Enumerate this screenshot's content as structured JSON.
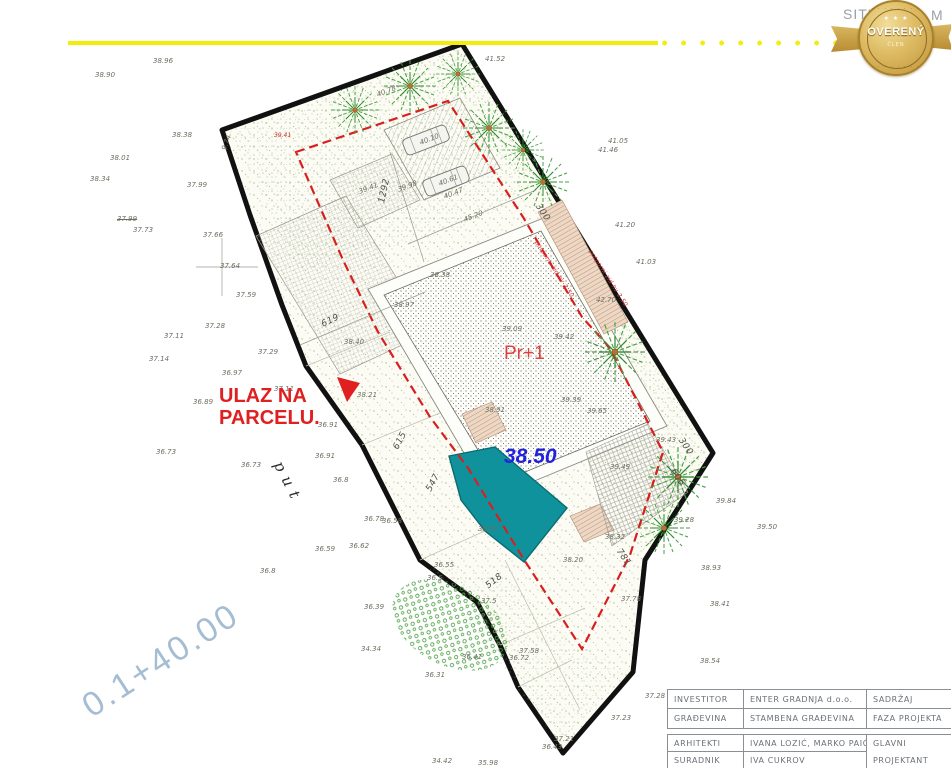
{
  "page": {
    "scale_note_left": "SITU",
    "scale_note_right": "M 1 :"
  },
  "badge": {
    "main": "OVERENÝ",
    "sub": "ČLEN",
    "stars": "★ ★ ★",
    "arc_top": "· · · · · · · ·",
    "arc_bottom": "· · · · · · · ·"
  },
  "plan": {
    "entrance_line1": "ULAZ NA",
    "entrance_line2": "PARCELU.",
    "building_label": "Pr+1",
    "pool_elevation": "38.50",
    "road_label": "put",
    "section_mark": "0.1+40.00",
    "labels": [
      {
        "t": "38.96",
        "x": 153,
        "y": 57
      },
      {
        "t": "38.90",
        "x": 95,
        "y": 71
      },
      {
        "t": "38.38",
        "x": 172,
        "y": 131
      },
      {
        "t": "38.01",
        "x": 110,
        "y": 154
      },
      {
        "t": "38.34",
        "x": 90,
        "y": 175
      },
      {
        "t": "37.99",
        "x": 187,
        "y": 181
      },
      {
        "t": "37.99",
        "x": 117,
        "y": 215,
        "cls": "strike"
      },
      {
        "t": "37.73",
        "x": 133,
        "y": 226
      },
      {
        "t": "37.66",
        "x": 203,
        "y": 231
      },
      {
        "t": "37.64",
        "x": 220,
        "y": 262
      },
      {
        "t": "37.59",
        "x": 236,
        "y": 291
      },
      {
        "t": "37.28",
        "x": 205,
        "y": 322
      },
      {
        "t": "37.11",
        "x": 164,
        "y": 332
      },
      {
        "t": "37.14",
        "x": 149,
        "y": 355
      },
      {
        "t": "37.29",
        "x": 258,
        "y": 348
      },
      {
        "t": "36.97",
        "x": 222,
        "y": 369
      },
      {
        "t": "37.11",
        "x": 274,
        "y": 385
      },
      {
        "t": "36.89",
        "x": 193,
        "y": 398
      },
      {
        "t": "38.21",
        "x": 357,
        "y": 391
      },
      {
        "t": "36.91",
        "x": 318,
        "y": 421
      },
      {
        "t": "36.91",
        "x": 315,
        "y": 452
      },
      {
        "t": "36.73",
        "x": 156,
        "y": 448
      },
      {
        "t": "36.73",
        "x": 241,
        "y": 461
      },
      {
        "t": "36.8",
        "x": 333,
        "y": 476
      },
      {
        "t": "36.78",
        "x": 364,
        "y": 515
      },
      {
        "t": "36.58",
        "x": 382,
        "y": 517
      },
      {
        "t": "36.62",
        "x": 349,
        "y": 542
      },
      {
        "t": "36.59",
        "x": 315,
        "y": 545
      },
      {
        "t": "36.8",
        "x": 260,
        "y": 567
      },
      {
        "t": "36.39",
        "x": 364,
        "y": 603
      },
      {
        "t": "34.34",
        "x": 361,
        "y": 645
      },
      {
        "t": "36.41",
        "x": 462,
        "y": 653
      },
      {
        "t": "36.31",
        "x": 425,
        "y": 671
      },
      {
        "t": "34.42",
        "x": 432,
        "y": 757
      },
      {
        "t": "35.98",
        "x": 478,
        "y": 759
      },
      {
        "t": "36.43",
        "x": 542,
        "y": 743
      },
      {
        "t": "37.21",
        "x": 554,
        "y": 735
      },
      {
        "t": "37.5",
        "x": 481,
        "y": 597
      },
      {
        "t": "37.58",
        "x": 519,
        "y": 647
      },
      {
        "t": "36.72",
        "x": 509,
        "y": 654
      },
      {
        "t": "37.78",
        "x": 621,
        "y": 595
      },
      {
        "t": "37.23",
        "x": 611,
        "y": 714
      },
      {
        "t": "37.28",
        "x": 645,
        "y": 692
      },
      {
        "t": "38.54",
        "x": 700,
        "y": 657
      },
      {
        "t": "38.41",
        "x": 710,
        "y": 600
      },
      {
        "t": "38.93",
        "x": 701,
        "y": 564
      },
      {
        "t": "39.50",
        "x": 757,
        "y": 523
      },
      {
        "t": "39.84",
        "x": 716,
        "y": 497
      },
      {
        "t": "39.28",
        "x": 674,
        "y": 516
      },
      {
        "t": "38.32",
        "x": 605,
        "y": 533
      },
      {
        "t": "39.49",
        "x": 610,
        "y": 463
      },
      {
        "t": "39.39",
        "x": 561,
        "y": 396
      },
      {
        "t": "39.65",
        "x": 587,
        "y": 407
      },
      {
        "t": "38.91",
        "x": 485,
        "y": 406
      },
      {
        "t": "39.42",
        "x": 554,
        "y": 333
      },
      {
        "t": "39.09",
        "x": 502,
        "y": 325
      },
      {
        "t": "38.38",
        "x": 430,
        "y": 271
      },
      {
        "t": "38.97",
        "x": 394,
        "y": 301
      },
      {
        "t": "38.40",
        "x": 344,
        "y": 338
      },
      {
        "t": "45.20",
        "x": 464,
        "y": 216,
        "r": -21
      },
      {
        "t": "40.47",
        "x": 444,
        "y": 193,
        "r": -21
      },
      {
        "t": "40.10",
        "x": 420,
        "y": 139,
        "r": -21
      },
      {
        "t": "40.61",
        "x": 439,
        "y": 180,
        "r": -21
      },
      {
        "t": "39.98",
        "x": 398,
        "y": 186,
        "r": -21
      },
      {
        "t": "39.41",
        "x": 359,
        "y": 188,
        "r": -21
      },
      {
        "t": "40.78",
        "x": 377,
        "y": 91,
        "r": -21
      },
      {
        "t": "41.52",
        "x": 485,
        "y": 55
      },
      {
        "t": "41.05",
        "x": 608,
        "y": 137
      },
      {
        "t": "41.46",
        "x": 598,
        "y": 146
      },
      {
        "t": "41.20",
        "x": 615,
        "y": 221
      },
      {
        "t": "41.03",
        "x": 636,
        "y": 258
      },
      {
        "t": "39.43",
        "x": 656,
        "y": 436
      },
      {
        "t": "42.70",
        "x": 596,
        "y": 296
      },
      {
        "t": "38.20",
        "x": 563,
        "y": 556
      },
      {
        "t": "38.01",
        "x": 478,
        "y": 525
      },
      {
        "t": "36.55",
        "x": 434,
        "y": 561
      },
      {
        "t": "36.5",
        "x": 427,
        "y": 574
      },
      {
        "t": "9.74",
        "x": 224,
        "y": 146,
        "r": -70
      },
      {
        "t": "39.41",
        "x": 274,
        "y": 132,
        "cls": "red"
      },
      {
        "t": "1292",
        "x": 382,
        "y": 198,
        "r": -78,
        "cls": "dim"
      },
      {
        "t": "619",
        "x": 322,
        "y": 320,
        "r": -25,
        "cls": "dim"
      },
      {
        "t": "615",
        "x": 396,
        "y": 444,
        "r": -62,
        "cls": "dim"
      },
      {
        "t": "547",
        "x": 429,
        "y": 486,
        "r": -62,
        "cls": "dim"
      },
      {
        "t": "518",
        "x": 487,
        "y": 582,
        "r": -38,
        "cls": "dim"
      },
      {
        "t": "781",
        "x": 618,
        "y": 545,
        "r": 55,
        "cls": "dim"
      },
      {
        "t": "300",
        "x": 537,
        "y": 200,
        "r": 55,
        "cls": "dim"
      },
      {
        "t": "300",
        "x": 680,
        "y": 434,
        "r": 55,
        "cls": "dim"
      },
      {
        "t": "606",
        "x": 672,
        "y": 465,
        "r": 55,
        "cls": "dim"
      },
      {
        "t": "potporni zid hv 2.50",
        "x": 536,
        "y": 238,
        "r": 57,
        "cls": "note"
      },
      {
        "t": "potporni zid hv 2.50",
        "x": 590,
        "y": 247,
        "r": 57,
        "cls": "note"
      }
    ]
  },
  "titleblock": {
    "rows": [
      {
        "label": "INVESTITOR",
        "value": "ENTER GRADNJA d.o.o.",
        "side": "SADRŽAJ"
      },
      {
        "label": "GRAĐEVINA",
        "value": "STAMBENA  GRAĐEVINA",
        "side": "FAZA  PROJEKTA"
      },
      {
        "label": "ARHITEKTI",
        "value": "IVANA  LOZIĆ,  MARKO  PAIĆ",
        "side": "GLAVNI"
      },
      {
        "label": "SURADNIK",
        "value": "IVA CUKROV",
        "side": "PROJEKTANT"
      }
    ]
  },
  "colors": {
    "accent_yellow": "#f2ee0b",
    "boundary_black": "#111111",
    "setback_red": "#d81f1f",
    "pool_teal": "#10929c",
    "entrance_red": "#e02020",
    "elevation_blue": "#2222dd",
    "section_blue": "#a5bdd3",
    "badge_gold": "#caa43f"
  }
}
